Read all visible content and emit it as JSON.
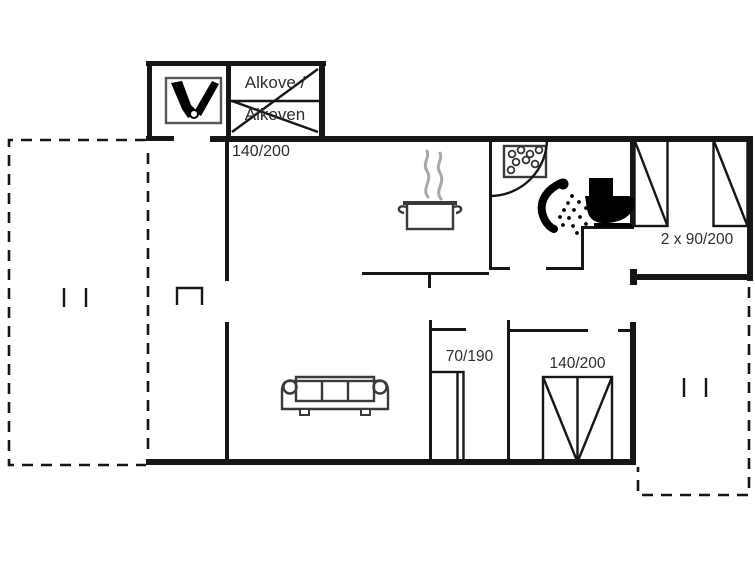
{
  "plan": {
    "type": "floor-plan",
    "colors": {
      "background": "#ffffff",
      "wall": "#161616",
      "icon": "#3a3a3a",
      "steam": "#a8a8a8",
      "text": "#2e2e2e"
    },
    "labels": {
      "alkove_line1": "Alkove /",
      "alkove_line2": "Alkoven",
      "alkove_bed_size": "140/200",
      "twin_beds_size": "2 x 90/200",
      "single_bed_size": "70/190",
      "double_bed_size": "140/200"
    },
    "rooms": [
      {
        "name": "stove-room",
        "feature": "wood-stove"
      },
      {
        "name": "alkove",
        "bed": "140/200"
      },
      {
        "name": "kitchen",
        "feature": "cooking-pot"
      },
      {
        "name": "bathroom",
        "features": [
          "washbasin",
          "shower",
          "toilet"
        ]
      },
      {
        "name": "bedroom-northeast",
        "beds": "2 x 90/200"
      },
      {
        "name": "bedroom-small",
        "bed": "70/190"
      },
      {
        "name": "bedroom-double",
        "bed": "140/200"
      },
      {
        "name": "living-room",
        "feature": "sofa"
      },
      {
        "name": "terrace-west",
        "style": "dashed"
      },
      {
        "name": "terrace-southeast",
        "style": "dashed"
      }
    ]
  }
}
